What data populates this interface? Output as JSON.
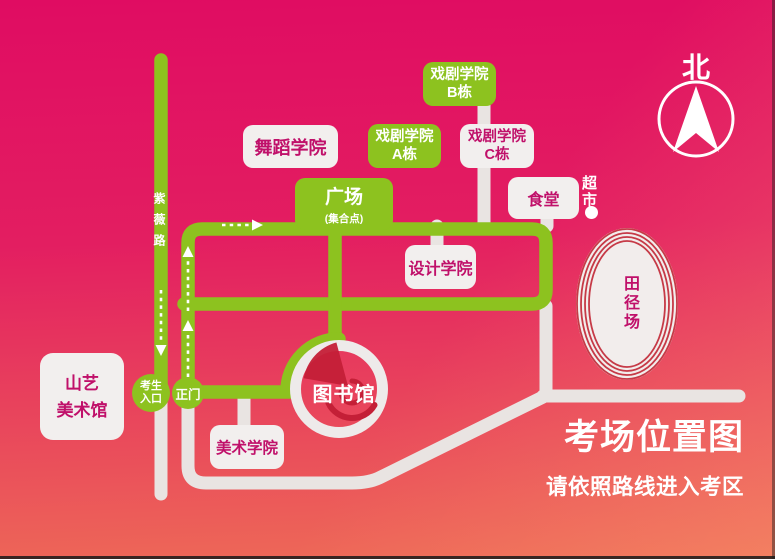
{
  "map": {
    "title": "考场位置图",
    "subtitle": "请依照路线进入考区",
    "compass_label": "北",
    "road_name": "紫薇路",
    "buildings": {
      "art_museum": {
        "line1": "山艺",
        "line2": "美术馆"
      },
      "dance": {
        "label": "舞蹈学院"
      },
      "drama_a": {
        "line1": "戏剧学院",
        "line2": "A栋"
      },
      "drama_b": {
        "line1": "戏剧学院",
        "line2": "B栋"
      },
      "drama_c": {
        "line1": "戏剧学院",
        "line2": "C栋"
      },
      "canteen": {
        "label": "食堂"
      },
      "supermarket": {
        "label": "超市"
      },
      "plaza": {
        "name": "广场",
        "note": "(集合点)"
      },
      "design": {
        "label": "设计学院"
      },
      "fine_arts": {
        "label": "美术学院"
      },
      "library": {
        "label": "图书馆"
      },
      "stadium": {
        "label": "田径场"
      }
    },
    "gates": {
      "candidate_entrance": {
        "line1": "考生",
        "line2": "入口"
      },
      "main_gate": {
        "label": "正门"
      }
    },
    "colors": {
      "route_green": "#8dc21f",
      "magenta_text": "#c0106a",
      "bg_top": "#e00c62",
      "bg_bottom": "#ee6b57",
      "road_gray": "#e9e4e2",
      "box_white": "#f2efee",
      "track_red": "#c63a47",
      "logo_red": "#c41f37",
      "route_dash_white": "#ffffff"
    }
  }
}
